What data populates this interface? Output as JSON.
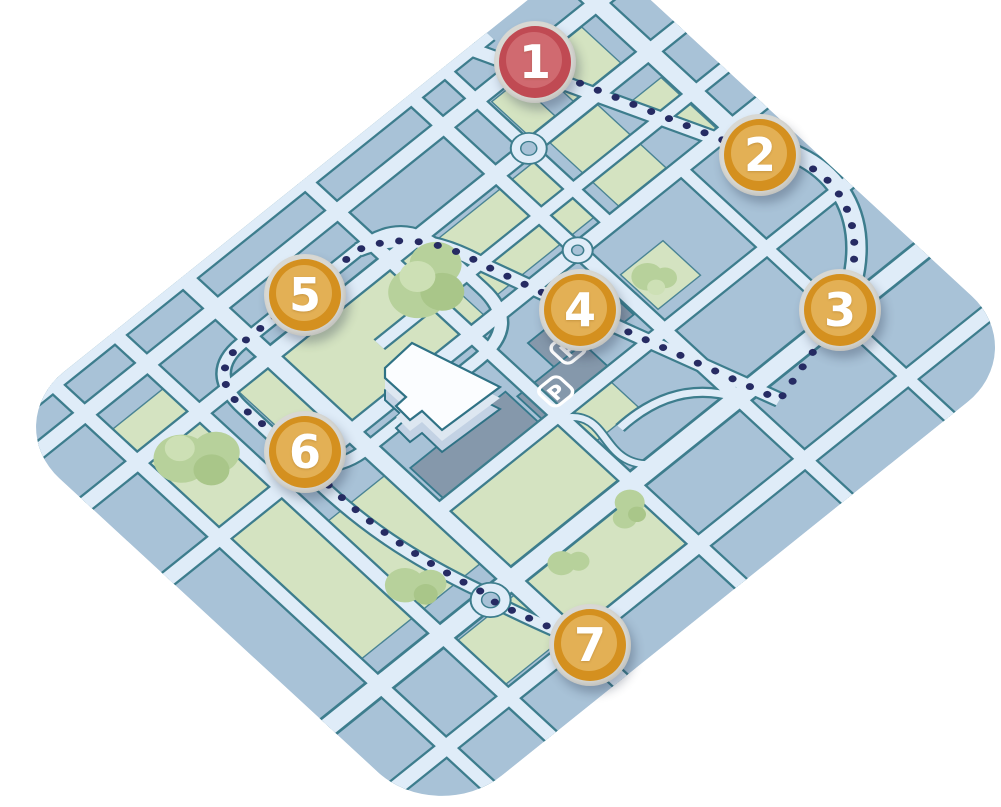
{
  "map": {
    "description": "illustrated-isometric-campus-route-map",
    "markers": [
      {
        "label": "1",
        "color": "#c04a53",
        "ring": "#d8d8d3",
        "kind": "route-start"
      },
      {
        "label": "2",
        "color": "#d4901f",
        "ring": "#d8d8d3",
        "kind": "route-stop"
      },
      {
        "label": "3",
        "color": "#d4901f",
        "ring": "#d8d8d3",
        "kind": "route-stop"
      },
      {
        "label": "4",
        "color": "#d4901f",
        "ring": "#d8d8d3",
        "kind": "route-stop"
      },
      {
        "label": "5",
        "color": "#d4901f",
        "ring": "#d8d8d3",
        "kind": "route-stop"
      },
      {
        "label": "6",
        "color": "#d4901f",
        "ring": "#d8d8d3",
        "kind": "route-stop"
      },
      {
        "label": "7",
        "color": "#d4901f",
        "ring": "#d8d8d3",
        "kind": "route-stop"
      }
    ],
    "parking_labels": [
      "P",
      "P"
    ],
    "route": {
      "style": "dotted",
      "dot_color": "#262b63",
      "stop_count": 7
    },
    "colors": {
      "background": "#ffffff",
      "map_base": "#a8c2d7",
      "road_fill": "#dfecf8",
      "road_casing": "#3d7d8d",
      "park_green": "#d4e3c1",
      "tree_green": "#b7d19b",
      "tree_light": "#cde0b5",
      "parking_gray": "#8598ab",
      "building_roof": "#fbfdff",
      "building_side": "#c3d2e4",
      "marker_orange": "#d4901f",
      "marker_red": "#c04a53",
      "marker_ring": "#d8d8d3",
      "route_dots": "#262b63"
    }
  }
}
